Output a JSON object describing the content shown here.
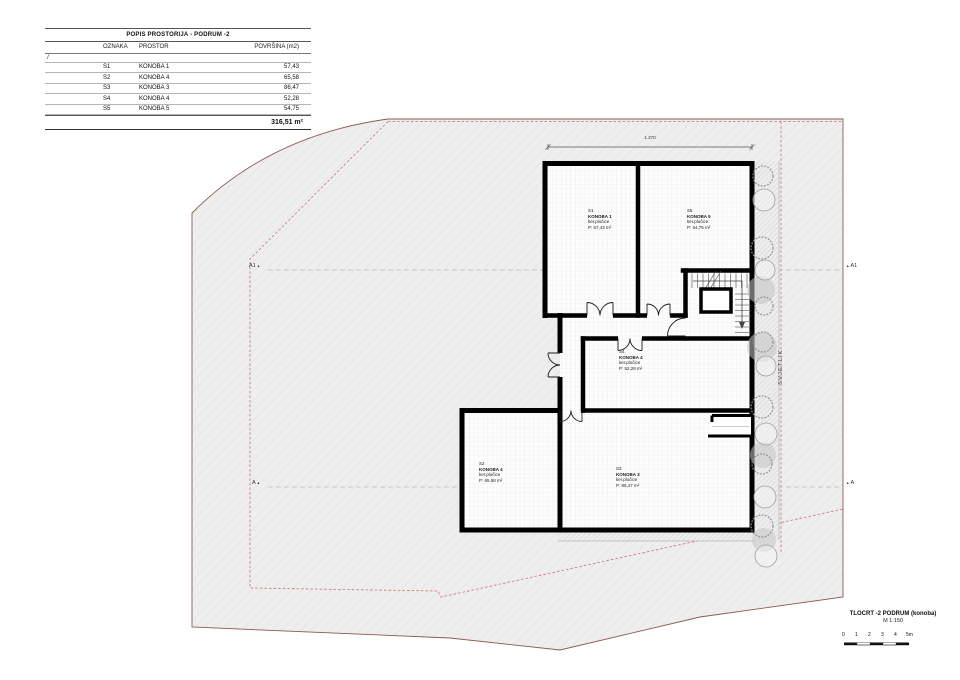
{
  "table": {
    "title": "POPIS PROSTORIJA - PODRUM -2",
    "headers": {
      "oznaka": "OZNAKA",
      "prostor": "PROSTOR",
      "povrsina": "POVRŠINA (m2)"
    },
    "group_marker": "/",
    "rows": [
      {
        "oznaka": "S1",
        "prostor": "KONOBA 1",
        "povrsina": "57,43"
      },
      {
        "oznaka": "S2",
        "prostor": "KONOBA 4",
        "povrsina": "65,58"
      },
      {
        "oznaka": "S3",
        "prostor": "KONOBA 3",
        "povrsina": "86,47"
      },
      {
        "oznaka": "S4",
        "prostor": "KONOBA 4",
        "povrsina": "52,28"
      },
      {
        "oznaka": "S5",
        "prostor": "KONOBA 5",
        "povrsina": "54,75"
      }
    ],
    "total": "316,51 m²"
  },
  "plan": {
    "top_dimension": "1.370",
    "lightwell_label": "SVJETLIK",
    "rooms": [
      {
        "id": "S1",
        "name": "KONOBA 1",
        "finish": "ker.pločice",
        "area": "P: 57,43 m²"
      },
      {
        "id": "S5",
        "name": "KONOBA 5",
        "finish": "ker.pločice",
        "area": "P: 54,75 m²"
      },
      {
        "id": "S4",
        "name": "KONOBA 4",
        "finish": "ker.pločice",
        "area": "P: 52,28 m²"
      },
      {
        "id": "S2",
        "name": "KONOBA 4",
        "finish": "ker.pločice",
        "area": "P: 65,58 m²"
      },
      {
        "id": "S3",
        "name": "KONOBA 3",
        "finish": "ker.pločice",
        "area": "P: 86,47 m²"
      }
    ],
    "markers": {
      "a1": "A1",
      "a": "A",
      "tri": "▲"
    }
  },
  "titleblock": {
    "title": "TLOCRT -2 PODRUM (konoba)",
    "scale": "M 1:150",
    "bar_labels": [
      "0",
      "1",
      "2",
      "3",
      "4",
      "5m"
    ]
  },
  "colors": {
    "wall": "#000000",
    "site_boundary": "#8a5a50",
    "setback_line": "#c87272",
    "tile_line": "#e3e3e6"
  }
}
